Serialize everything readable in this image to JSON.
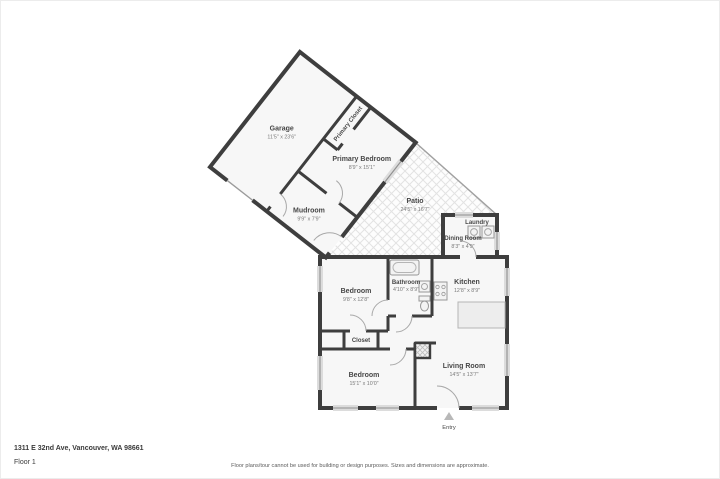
{
  "rooms": {
    "garage": {
      "name": "Garage",
      "dims": "11'5\" x 23'6\""
    },
    "primary_closet": {
      "name": "Primary Closet"
    },
    "primary_bedroom": {
      "name": "Primary Bedroom",
      "dims": "8'9\" x 15'1\""
    },
    "mudroom": {
      "name": "Mudroom",
      "dims": "9'9\" x 7'9\""
    },
    "patio": {
      "name": "Patio",
      "dims": "24'5\" x 16'7\""
    },
    "laundry": {
      "name": "Laundry"
    },
    "dining_room": {
      "name": "Dining Room",
      "dims": "8'3\" x 4'9\""
    },
    "kitchen": {
      "name": "Kitchen",
      "dims": "12'8\" x 8'9\""
    },
    "bathroom": {
      "name": "Bathroom",
      "dims": "4'10\" x 8'9\""
    },
    "bedroom_mid": {
      "name": "Bedroom",
      "dims": "9'8\" x 12'8\""
    },
    "closet": {
      "name": "Closet"
    },
    "bedroom_lower": {
      "name": "Bedroom",
      "dims": "15'1\" x 10'0\""
    },
    "living_room": {
      "name": "Living Room",
      "dims": "14'5\" x 13'7\""
    },
    "entry": {
      "name": "Entry"
    }
  },
  "footer": {
    "address": "1311 E 32nd Ave, Vancouver, WA 98661",
    "floor": "Floor 1",
    "disclaimer": "Floor plans/tour cannot be used for building or design purposes. Sizes and dimensions are approximate."
  },
  "colors": {
    "wall": "#3e3e3e",
    "room_fill": "#f7f7f7",
    "hatch_line": "#e3e3e3",
    "text": "#474747"
  }
}
